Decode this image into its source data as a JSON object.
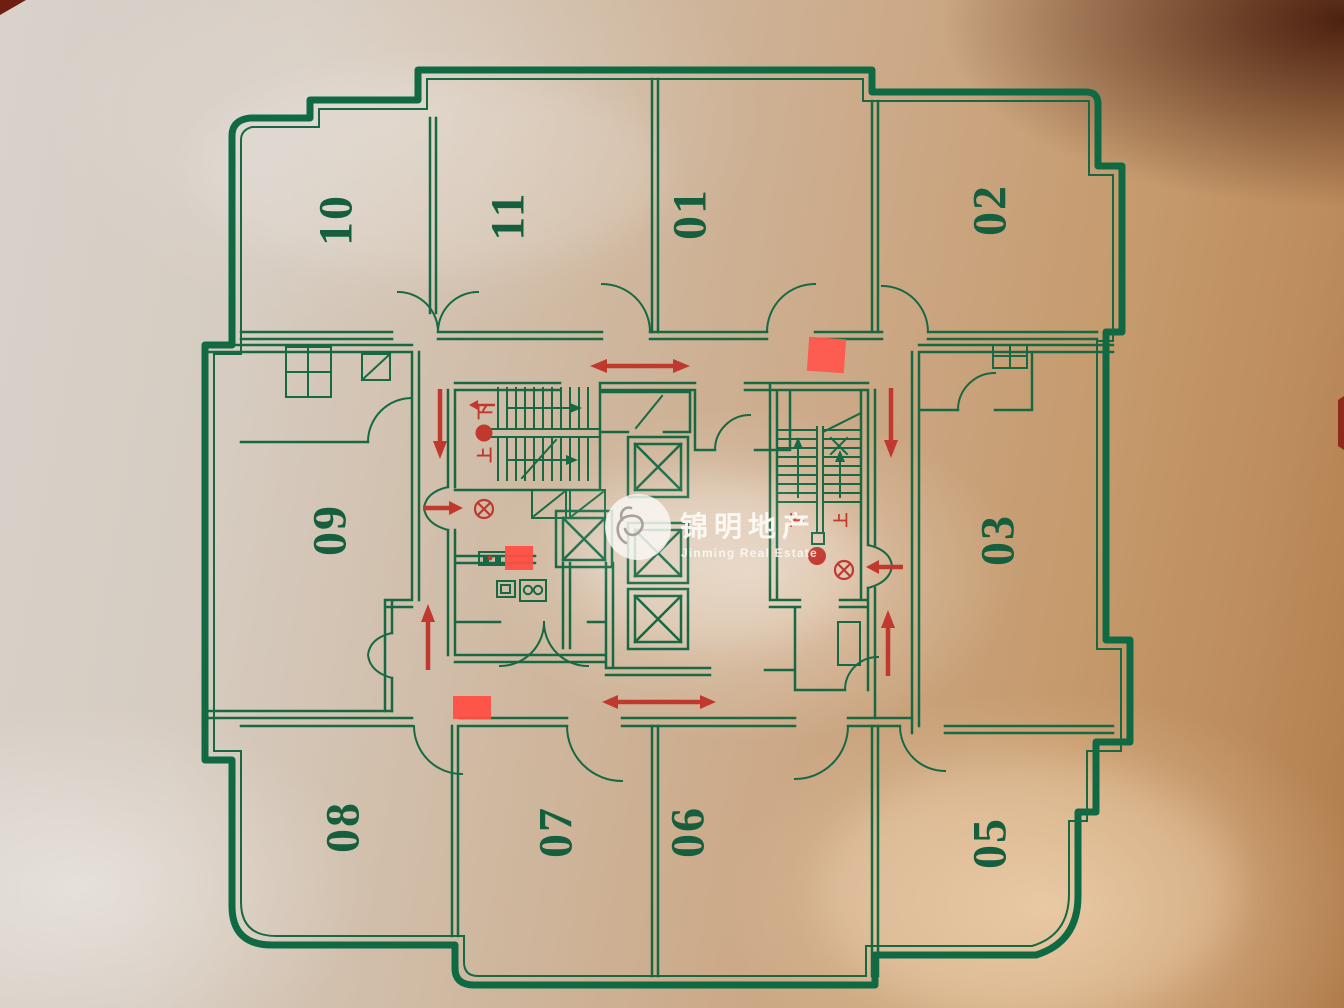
{
  "plaque": {
    "kind": "photographed building evacuation floor plan",
    "rooms": {
      "r10": "10",
      "r11": "11",
      "r01": "01",
      "r02": "02",
      "r09": "09",
      "r03": "03",
      "r08": "08",
      "r07": "07",
      "r06": "06",
      "r05": "05"
    },
    "stair_symbols": {
      "up": "上",
      "down": "下"
    },
    "watermark": {
      "cn": "锦明地产",
      "en": "Jinming Real Estate"
    },
    "colors": {
      "plan_line_green": "#166943",
      "room_number_green": "#155f3e",
      "marking_red": "#c0392f",
      "highlight_red": "#ff5348",
      "background_metallic": "#cfb8a0"
    }
  }
}
